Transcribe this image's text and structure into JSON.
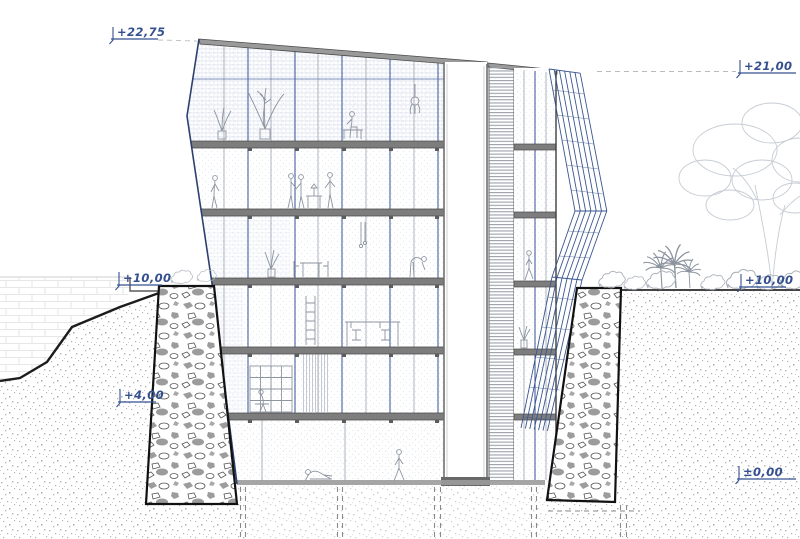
{
  "drawing": {
    "name": "building cross-section",
    "kind": "architectural section through hillside building with central core, gabion retaining walls and louvered facade screen"
  },
  "colors": {
    "annotation_blue": "#35508f",
    "screen_blue": "#3a568f",
    "facade_edge_blue": "#2e4070",
    "slab_gray": "#7d7d7d",
    "outline_dark": "#3c3c3c",
    "earth_stipple_gray": "#a6a6a6",
    "vegetation_gray": "#c6ccd4"
  },
  "elevation_labels": [
    {
      "id": "top-left",
      "text": "+22,75"
    },
    {
      "id": "top-right",
      "text": "+21,00"
    },
    {
      "id": "street-left",
      "text": "+10,00"
    },
    {
      "id": "street-right",
      "text": "+10,00"
    },
    {
      "id": "mid-left",
      "text": "+4,00"
    },
    {
      "id": "base-right",
      "text": "±0,00"
    }
  ]
}
